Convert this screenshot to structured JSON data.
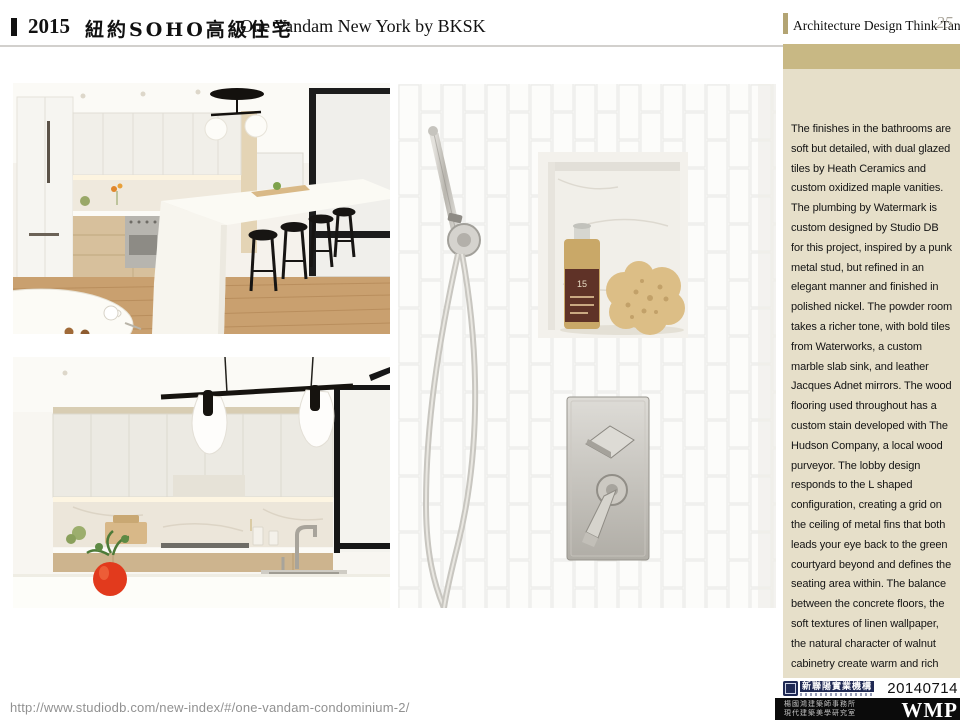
{
  "header": {
    "title_year": "2015",
    "title_zh": "紐約SOHO高級住宅",
    "title_en": "One Vandam New York by BKSK",
    "right_label": "Architecture Design Think Tank",
    "page_number": "25"
  },
  "sidebar": {
    "body_text": "The finishes in the bathrooms are soft but detailed, with dual glazed tiles by Heath Ceramics and custom oxidized maple vanities.  The plumbing by Watermark is custom designed by Studio DB for this project, inspired by a punk metal stud, but refined in an elegant manner and finished in polished nickel.  The powder room takes a richer tone, with bold tiles from Waterworks, a custom marble slab sink, and leather Jacques Adnet mirrors. The wood flooring used throughout has a custom stain developed with The Hudson Company, a local wood purveyor. The lobby design responds to the L shaped configuration, creating a grid on the ceiling of metal fins that both leads your eye back to the green courtyard beyond and defines the seating area within.  The balance between the concrete floors, the soft textures of linen wallpaper, the natural character of walnut cabinetry create warm and rich common spaces."
  },
  "photos": {
    "shower": {
      "bottle_label": "15"
    }
  },
  "footer": {
    "url": "http://www.studiodb.com/new-index/#/one-vandam-condominium-2/",
    "date": "20140714",
    "agency_logo_text": "新聯陽實業機構",
    "firm_line1": "楊國鴻建築師事務所",
    "firm_line2": "現代建築美學研究室",
    "brand": "WMP"
  },
  "colors": {
    "sidebar_band": "#c8b884",
    "sidebar_bg": "#e6dfc9",
    "footer_bar": "#0b0b0b",
    "agency_navy": "#202a54"
  }
}
